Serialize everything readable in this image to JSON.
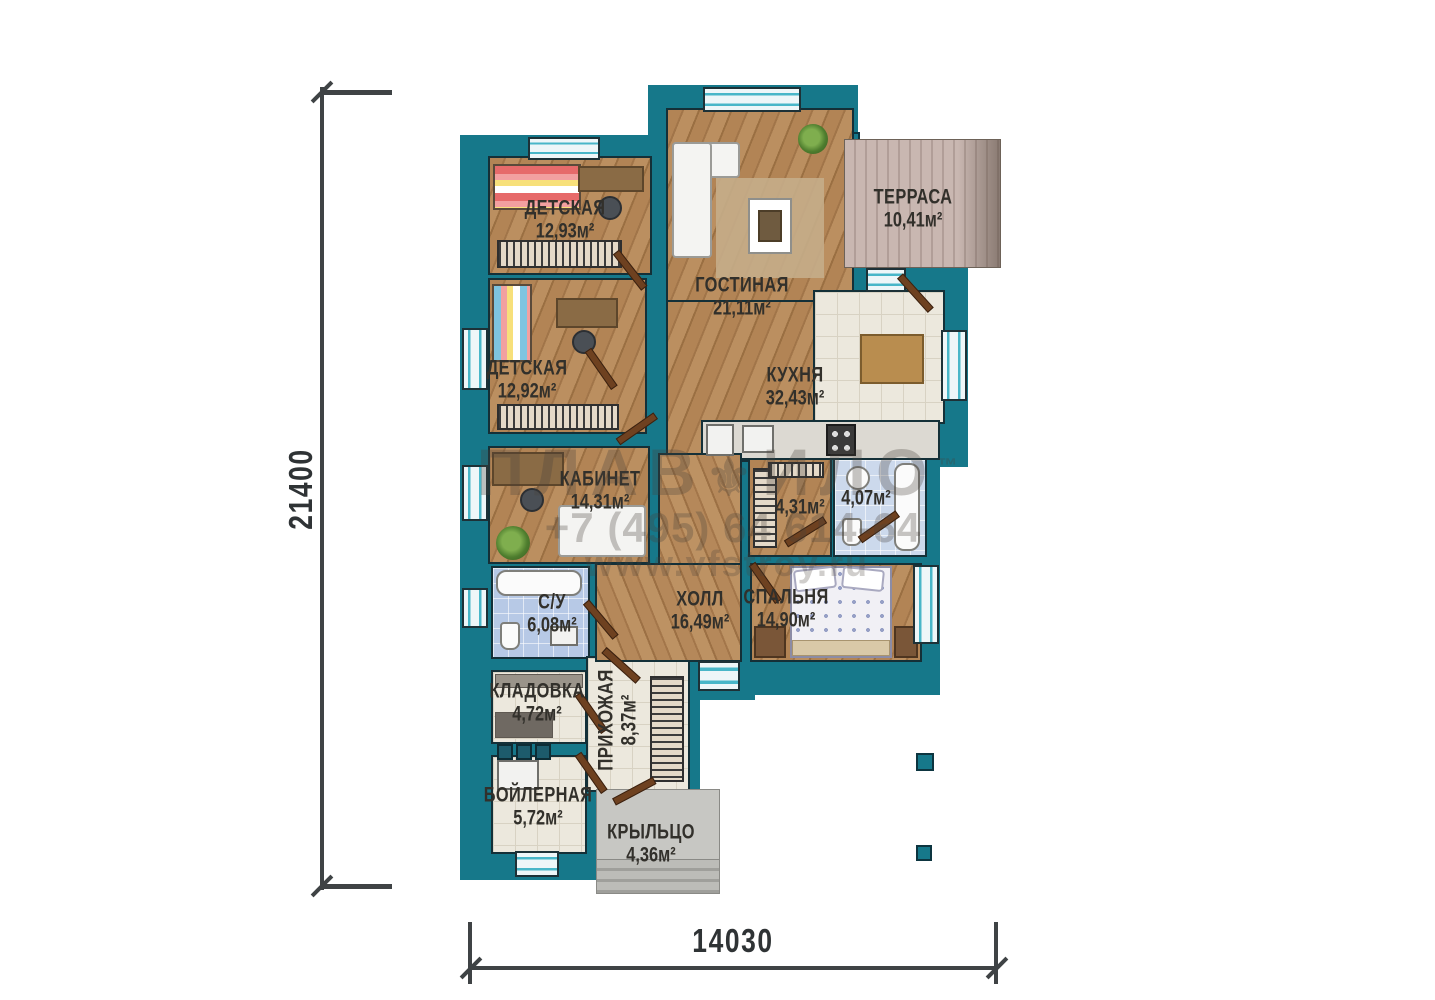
{
  "dimensions": {
    "vertical": "21400",
    "horizontal": "14030"
  },
  "rooms": [
    {
      "name": "ДЕТСКАЯ",
      "area": "12,93м²"
    },
    {
      "name": "ДЕТСКАЯ",
      "area": "12,92м²"
    },
    {
      "name": "ГОСТИНАЯ",
      "area": "21,11м²"
    },
    {
      "name": "ТЕРРАСА",
      "area": "10,41м²"
    },
    {
      "name": "КУХНЯ",
      "area": "32,43м²"
    },
    {
      "name": "КАБИНЕТ",
      "area": "14,31м²"
    },
    {
      "name": "",
      "area": "4,31м²"
    },
    {
      "name": "",
      "area": "4,07м²"
    },
    {
      "name": "С/У",
      "area": "6,08м²"
    },
    {
      "name": "ХОЛЛ",
      "area": "16,49м²"
    },
    {
      "name": "СПАЛЬНЯ",
      "area": "14,90м²"
    },
    {
      "name": "КЛАДОВКА",
      "area": "4,72м²"
    },
    {
      "name": "ПРИХОЖАЯ",
      "area": "8,37м²"
    },
    {
      "name": "БОЙЛЕРНАЯ",
      "area": "5,72м²"
    },
    {
      "name": "КРЫЛЬЦО",
      "area": "4,36м²"
    }
  ],
  "watermark": {
    "logo_left": "ПЛАВ",
    "logo_icon": "⚜",
    "logo_right": "ИЛО",
    "tm": "™",
    "phone": "+7 (495) 64 614-64",
    "site": "www.vfstroy.ru"
  },
  "colors": {
    "wall": "#16788a",
    "window_accent": "#49b6c8",
    "wood": "#ad7c4e",
    "tile": "#ece8dd",
    "bath_tile": "#b7c9e6",
    "deck": "#c3b1ab",
    "label": "#32302b"
  }
}
